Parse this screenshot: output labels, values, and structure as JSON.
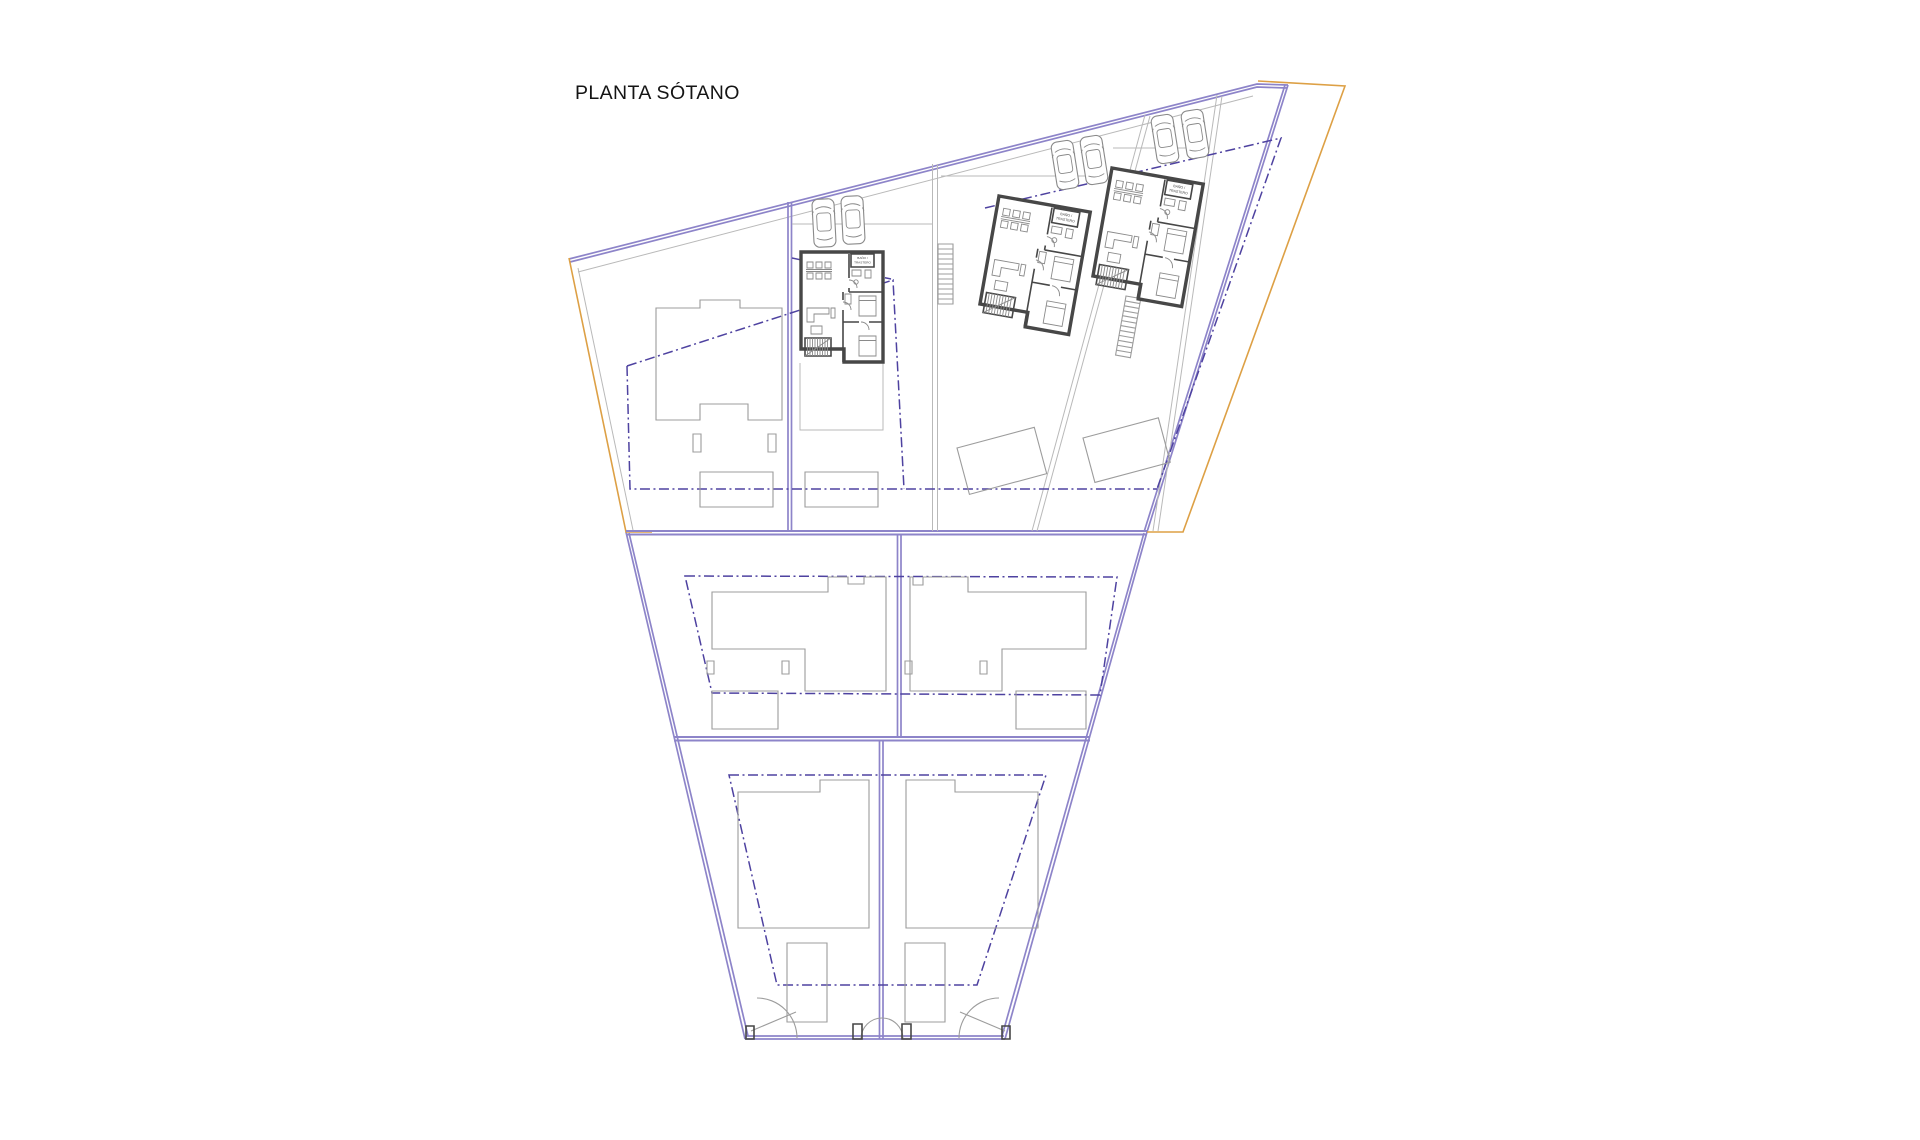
{
  "title": "PLANTA SÓTANO",
  "villa_labels": {
    "line1": "BAÑO /",
    "line2": "TRASTERO"
  },
  "summary": {
    "detailed_basement_villas": 3,
    "outlined_houses": 5,
    "parked_cars": 6,
    "plot_sections": 3
  },
  "colors": {
    "bg": "#ffffff",
    "boundary": "#8d84c9",
    "dash": "#4e42a0",
    "orange": "#dda045",
    "outline": "#9c9c9c",
    "outline2": "#b9b9b9",
    "wall": "#474747",
    "furn": "#8a8a8a",
    "text": "#141414"
  }
}
